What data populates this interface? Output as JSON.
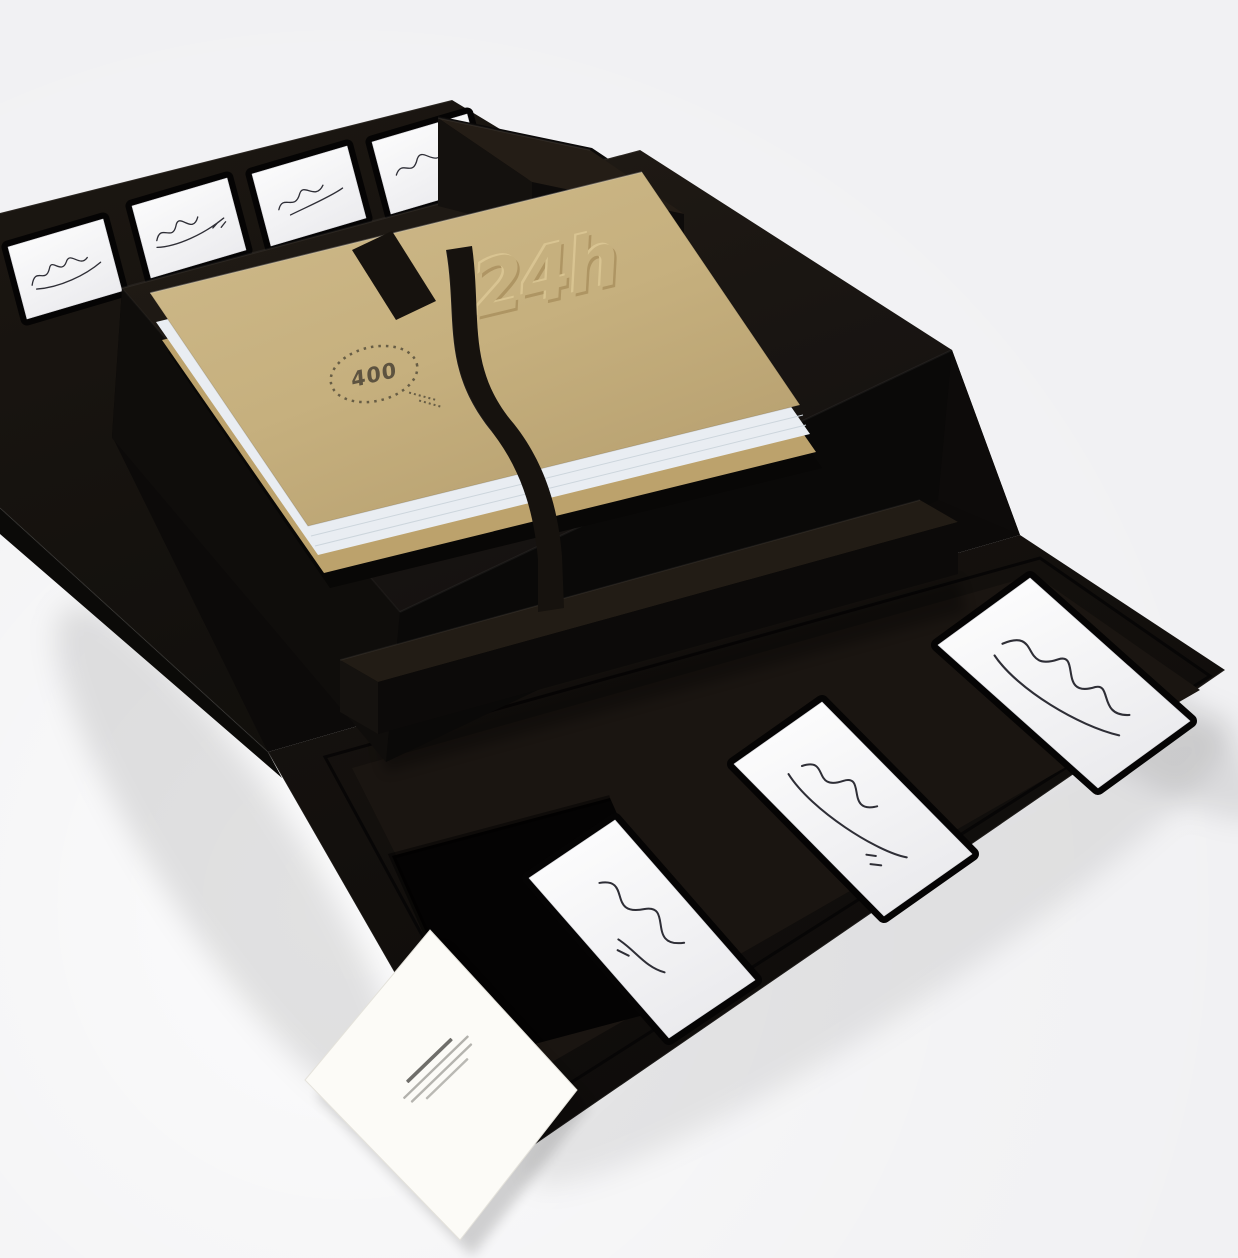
{
  "scene": {
    "type": "product-render",
    "description": "Open black collector's presentation box: a kraft-tan book embossed with the 24h logo and a 400 limited-edition stamp sits in a black tray with a black ribbon bookmark; white autograph cards are displayed in recessed slots on the opened lid and front flap; one recess is empty and a small white caption card leans over the front edge.",
    "background_color": "#f1f1f3"
  },
  "palette": {
    "box_top": "#1f1914",
    "box_front": "#100e0c",
    "box_dark": "#0a0908",
    "slot_recess": "#050404",
    "card_white": "#ffffff",
    "signature_ink": "#2e2e36"
  },
  "book": {
    "embossed_logo": "24h",
    "stamp_text": "400",
    "cover_color": "#c6b07e",
    "board_color": "#bca26c",
    "page_edge_color": "#e9edf2",
    "ribbon_color": "#16120e",
    "stamp_ink": "#5d5340"
  },
  "lid_cards": [
    {
      "label": "autograph card 1"
    },
    {
      "label": "autograph card 2"
    },
    {
      "label": "autograph card 3"
    },
    {
      "label": "autograph card 4"
    }
  ],
  "flap_cards": [
    {
      "label": "autograph card right"
    },
    {
      "label": "autograph card middle"
    },
    {
      "label": "autograph card left"
    }
  ],
  "flap_empty_slot": {
    "label": "empty card recess"
  },
  "info_card": {
    "label": "caption card",
    "text_legible": false,
    "text_lines": 4,
    "color": "#fcfbf7"
  }
}
